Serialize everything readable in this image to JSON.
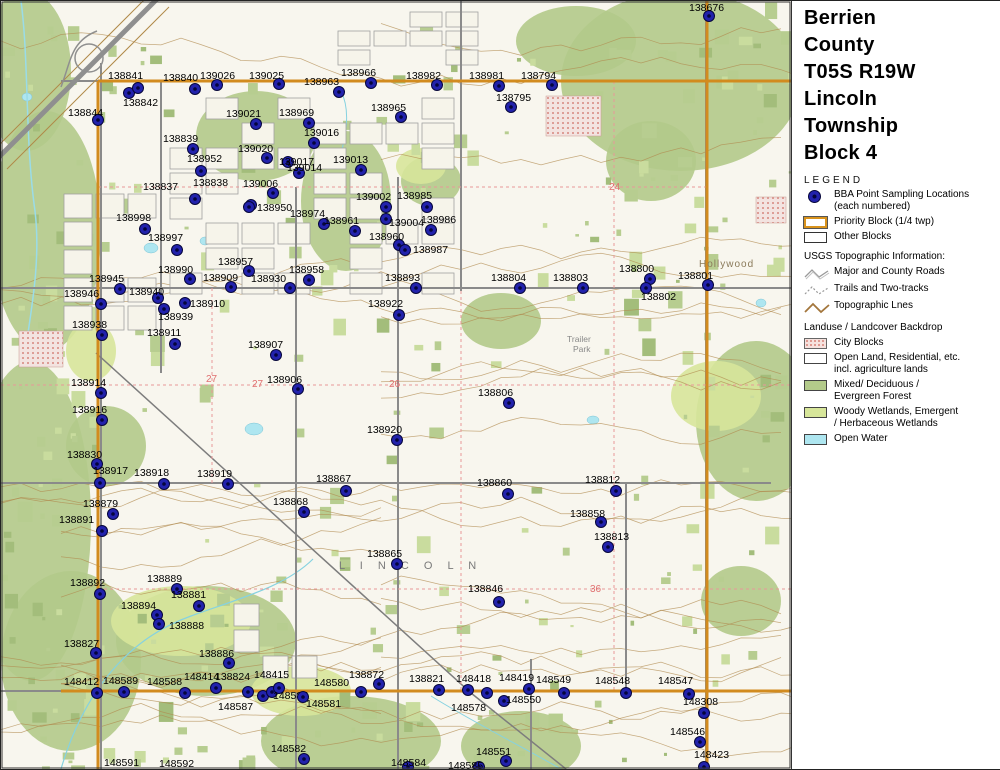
{
  "panel": {
    "title_lines": [
      "Berrien",
      "County",
      "T05S R19W",
      "Lincoln",
      "Township",
      "Block 4"
    ],
    "legend_title": "LEGEND",
    "legend": [
      {
        "type": "item",
        "icon": "bba-dot",
        "lines": [
          "BBA Point Sampling Locations",
          "(each numbered)"
        ]
      },
      {
        "type": "item",
        "icon": "priority-rect",
        "lines": [
          "Priority Block (1/4 twp)"
        ]
      },
      {
        "type": "item",
        "icon": "other-rect",
        "lines": [
          "Other Blocks"
        ]
      },
      {
        "type": "heading",
        "lines": [
          "USGS Topographic Information:"
        ]
      },
      {
        "type": "item",
        "icon": "roads-line",
        "lines": [
          "Major and County Roads"
        ]
      },
      {
        "type": "item",
        "icon": "trails-line",
        "lines": [
          "Trails and Two-tracks"
        ]
      },
      {
        "type": "item",
        "icon": "topo-line",
        "lines": [
          "Topographic Lnes"
        ]
      },
      {
        "type": "heading",
        "lines": [
          "Landuse / Landcover Backdrop"
        ]
      },
      {
        "type": "item",
        "icon": "city-rect",
        "lines": [
          "City Blocks"
        ]
      },
      {
        "type": "item",
        "icon": "open-rect",
        "lines": [
          "Open Land, Residential, etc.",
          "incl. agriculture lands"
        ]
      },
      {
        "type": "item",
        "icon": "forest-rect",
        "lines": [
          "Mixed/ Deciduous /",
          "Evergreen Forest"
        ]
      },
      {
        "type": "item",
        "icon": "wetland-rect",
        "lines": [
          "Woody Wetlands, Emergent",
          "/ Herbaceous Wetlands"
        ]
      },
      {
        "type": "item",
        "icon": "water-rect",
        "lines": [
          "Open Water"
        ]
      }
    ],
    "logo": {
      "state": "MICHIGAN",
      "subtitle": "Breeding Bird Atlas",
      "years": "2002 - 2007",
      "numeral": "II"
    },
    "north_label": "N",
    "scale_miles": {
      "ticks": [
        "0",
        "0.1",
        "0.2",
        "0.3",
        "0.4",
        "0.5"
      ],
      "unit": "Miles"
    },
    "scale_km": {
      "ticks": [
        "0",
        "0.2",
        "0.4",
        "0.6"
      ],
      "unit": "Kilometers"
    },
    "revision": "(rev. 2005 may 18)"
  },
  "map": {
    "colors": {
      "priority": "#d28b1e",
      "forest": "#b3ca8a",
      "wetland": "#d7e69a",
      "water": "#aee6f0",
      "city": "#e8a7a7",
      "contour": "#b18a4e",
      "road": "#8a8a8a",
      "point_fill": "#2222ac",
      "point_core": "#05053c"
    },
    "points": [
      [
        "138676",
        688,
        1,
        708,
        15
      ],
      [
        "138841",
        107,
        69,
        128,
        92
      ],
      [
        "138842",
        122,
        96,
        137,
        87
      ],
      [
        "138840",
        162,
        71,
        194,
        88
      ],
      [
        "139026",
        199,
        69,
        216,
        84
      ],
      [
        "139025",
        248,
        69,
        278,
        83
      ],
      [
        "138963",
        303,
        75,
        338,
        91
      ],
      [
        "138966",
        340,
        66,
        370,
        82
      ],
      [
        "138982",
        405,
        69,
        436,
        84
      ],
      [
        "138981",
        468,
        69,
        498,
        85
      ],
      [
        "138794",
        520,
        69,
        551,
        84
      ],
      [
        "138795",
        495,
        91,
        510,
        106
      ],
      [
        "138844",
        67,
        106,
        97,
        119
      ],
      [
        "139021",
        225,
        107,
        255,
        123
      ],
      [
        "138969",
        278,
        106,
        308,
        122
      ],
      [
        "138965",
        370,
        101,
        400,
        116
      ],
      [
        "138839",
        162,
        132,
        192,
        148
      ],
      [
        "139020",
        237,
        142,
        266,
        157
      ],
      [
        "139016",
        303,
        126,
        313,
        142
      ],
      [
        "138952",
        186,
        152,
        200,
        170
      ],
      [
        "139017",
        278,
        155,
        287,
        161
      ],
      [
        "139014",
        286,
        161,
        298,
        172
      ],
      [
        "139013",
        332,
        153,
        360,
        169
      ],
      [
        "138837",
        142,
        180,
        194,
        198
      ],
      [
        "138838",
        192,
        176,
        250,
        204
      ],
      [
        "139006",
        242,
        177,
        272,
        192
      ],
      [
        "139002",
        355,
        190,
        385,
        206
      ],
      [
        "138985",
        396,
        189,
        426,
        206
      ],
      [
        "138950",
        256,
        201,
        248,
        206
      ],
      [
        "138974",
        289,
        207,
        323,
        223
      ],
      [
        "138961",
        323,
        214,
        354,
        230
      ],
      [
        "139004",
        388,
        216,
        385,
        218
      ],
      [
        "138986",
        420,
        213,
        430,
        229
      ],
      [
        "138960",
        368,
        230,
        398,
        244
      ],
      [
        "138987",
        412,
        243,
        404,
        249
      ],
      [
        "138998",
        115,
        211,
        144,
        228
      ],
      [
        "138997",
        147,
        231,
        176,
        249
      ],
      [
        "138990",
        157,
        263,
        189,
        278
      ],
      [
        "138957",
        217,
        255,
        248,
        270
      ],
      [
        "138909",
        202,
        271,
        230,
        286
      ],
      [
        "138945",
        88,
        272,
        119,
        288
      ],
      [
        "138946",
        63,
        287,
        100,
        303
      ],
      [
        "138940",
        128,
        285,
        157,
        297
      ],
      [
        "138910",
        189,
        297,
        184,
        302
      ],
      [
        "138939",
        157,
        310,
        163,
        308
      ],
      [
        "138938",
        71,
        318,
        101,
        334
      ],
      [
        "138911",
        146,
        326,
        174,
        343
      ],
      [
        "138958",
        288,
        263,
        308,
        279
      ],
      [
        "138930",
        250,
        272,
        289,
        287
      ],
      [
        "138893",
        384,
        271,
        415,
        287
      ],
      [
        "138804",
        490,
        271,
        519,
        287
      ],
      [
        "138803",
        552,
        271,
        582,
        287
      ],
      [
        "138800",
        618,
        262,
        649,
        278
      ],
      [
        "138802",
        640,
        290,
        645,
        287
      ],
      [
        "138801",
        677,
        269,
        707,
        284
      ],
      [
        "138922",
        367,
        297,
        398,
        314
      ],
      [
        "138907",
        247,
        338,
        275,
        354
      ],
      [
        "138906",
        266,
        373,
        297,
        388
      ],
      [
        "138806",
        477,
        386,
        508,
        402
      ],
      [
        "138914",
        70,
        376,
        100,
        392
      ],
      [
        "138916",
        71,
        403,
        101,
        419
      ],
      [
        "138920",
        366,
        423,
        396,
        439
      ],
      [
        "138830",
        66,
        448,
        96,
        463
      ],
      [
        "138917",
        92,
        464,
        99,
        482
      ],
      [
        "138918",
        133,
        466,
        163,
        483
      ],
      [
        "138919",
        196,
        467,
        227,
        483
      ],
      [
        "138867",
        315,
        472,
        345,
        490
      ],
      [
        "138860",
        476,
        476,
        507,
        493
      ],
      [
        "138812",
        584,
        473,
        615,
        490
      ],
      [
        "138879",
        82,
        497,
        112,
        513
      ],
      [
        "138891",
        58,
        513,
        101,
        530
      ],
      [
        "138868",
        272,
        495,
        303,
        511
      ],
      [
        "138858",
        569,
        507,
        600,
        521
      ],
      [
        "138813",
        593,
        530,
        607,
        546
      ],
      [
        "138865",
        366,
        547,
        396,
        563
      ],
      [
        "138846",
        467,
        582,
        498,
        601
      ],
      [
        "138892",
        69,
        576,
        99,
        593
      ],
      [
        "138889",
        146,
        572,
        176,
        588
      ],
      [
        "138881",
        170,
        588,
        198,
        605
      ],
      [
        "138894",
        120,
        599,
        156,
        614
      ],
      [
        "138888",
        168,
        619,
        158,
        623
      ],
      [
        "138827",
        63,
        637,
        95,
        652
      ],
      [
        "138886",
        198,
        647,
        228,
        662
      ],
      [
        "148412",
        63,
        675,
        96,
        692
      ],
      [
        "148589",
        102,
        674,
        123,
        691
      ],
      [
        "148588",
        146,
        675,
        184,
        692
      ],
      [
        "148414",
        183,
        670,
        215,
        687
      ],
      [
        "138824",
        214,
        670,
        247,
        691
      ],
      [
        "148587",
        217,
        700,
        262,
        695
      ],
      [
        "148415",
        253,
        668,
        271,
        691
      ],
      [
        "148585",
        272,
        689,
        278,
        687
      ],
      [
        "148581",
        305,
        697,
        302,
        696
      ],
      [
        "148580",
        313,
        676,
        360,
        691
      ],
      [
        "138872",
        348,
        668,
        378,
        683
      ],
      [
        "138821",
        408,
        672,
        438,
        689
      ],
      [
        "148418",
        455,
        672,
        467,
        689
      ],
      [
        "",
        0,
        0,
        486,
        692
      ],
      [
        "148578",
        450,
        701,
        503,
        700
      ],
      [
        "148419",
        498,
        671,
        528,
        688
      ],
      [
        "148549",
        535,
        673,
        563,
        692
      ],
      [
        "148550",
        505,
        693,
        -1,
        -1
      ],
      [
        "148548",
        594,
        674,
        625,
        692
      ],
      [
        "148547",
        657,
        674,
        688,
        693
      ],
      [
        "148308",
        682,
        695,
        703,
        712
      ],
      [
        "148546",
        669,
        725,
        699,
        741
      ],
      [
        "148423",
        693,
        748,
        703,
        766
      ],
      [
        "148582",
        270,
        742,
        303,
        758
      ],
      [
        "148584",
        390,
        756,
        407,
        766
      ],
      [
        "148585",
        447,
        759,
        478,
        766
      ],
      [
        "148551",
        475,
        745,
        505,
        760
      ],
      [
        "148591",
        103,
        756,
        -1,
        -1
      ],
      [
        "148592",
        158,
        757,
        -1,
        -1
      ]
    ],
    "place_labels": [
      {
        "text": "L I N C O L N",
        "x": 338,
        "y": 568,
        "size": 11,
        "spacing": 6,
        "color": "#7a7a7a"
      },
      {
        "text": "Hollywood",
        "x": 698,
        "y": 266,
        "size": 10,
        "spacing": 1,
        "color": "#8a7a5a"
      },
      {
        "text": "Trailer",
        "x": 566,
        "y": 341,
        "size": 8.5,
        "spacing": 0,
        "color": "#888888"
      },
      {
        "text": "Park",
        "x": 572,
        "y": 351,
        "size": 8.5,
        "spacing": 0,
        "color": "#888888"
      }
    ],
    "section_numbers": [
      {
        "text": "27",
        "x": 205,
        "y": 381
      },
      {
        "text": "27",
        "x": 251,
        "y": 386
      },
      {
        "text": "26",
        "x": 388,
        "y": 386
      },
      {
        "text": "24",
        "x": 608,
        "y": 189
      },
      {
        "text": "36",
        "x": 589,
        "y": 591
      }
    ]
  }
}
